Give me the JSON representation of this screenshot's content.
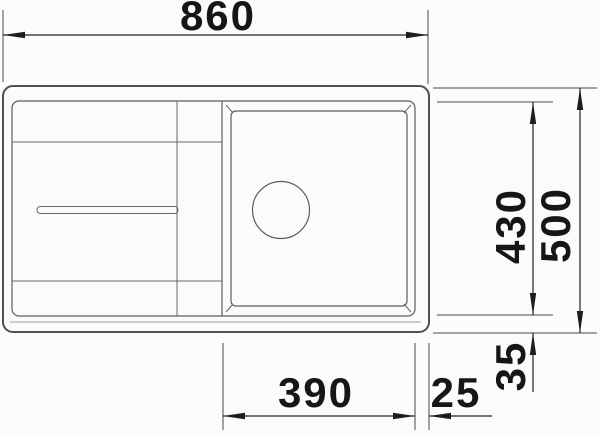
{
  "drawing": {
    "type": "sink-top-view-dimension-drawing",
    "dimension_labels": {
      "overall_width_top": "860",
      "overall_depth_right": "500",
      "bowl_depth_right": "430",
      "bowl_width_bottom": "390",
      "rim_gap_bottom": "25",
      "rim_offset_right": "35"
    },
    "colors": {
      "background": "#fbfbfb",
      "drawing_lines": "#5d5d5d",
      "dimension_lines": "#222222",
      "text": "#161616"
    }
  }
}
